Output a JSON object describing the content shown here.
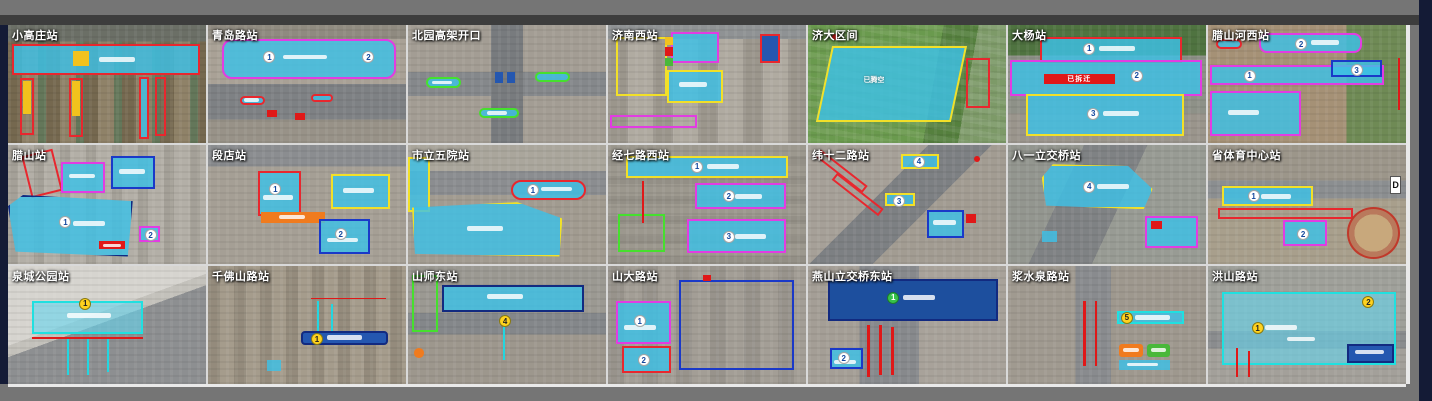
{
  "grid": {
    "columns": 7,
    "rows": 3
  },
  "tiles": [
    {
      "label": "小高庄站",
      "annotations": []
    },
    {
      "label": "青岛路站",
      "annotations": [
        "1",
        "2"
      ]
    },
    {
      "label": "北园高架开口",
      "annotations": []
    },
    {
      "label": "济南西站",
      "annotations": []
    },
    {
      "label": "济大区间",
      "annotations": [
        "已腾空"
      ]
    },
    {
      "label": "大杨站",
      "annotations": [
        "1",
        "2",
        "3",
        "已拆迁"
      ]
    },
    {
      "label": "腊山河西站",
      "annotations": [
        "2",
        "1",
        "3"
      ]
    },
    {
      "label": "腊山站",
      "annotations": [
        "1",
        "2"
      ]
    },
    {
      "label": "段店站",
      "annotations": [
        "1",
        "2"
      ]
    },
    {
      "label": "市立五院站",
      "annotations": [
        "1"
      ]
    },
    {
      "label": "经七路西站",
      "annotations": [
        "1",
        "2",
        "3"
      ]
    },
    {
      "label": "纬十二路站",
      "annotations": [
        "4",
        "3"
      ]
    },
    {
      "label": "八一立交桥站",
      "annotations": [
        "4"
      ]
    },
    {
      "label": "省体育中心站",
      "annotations": [
        "1",
        "2",
        "D"
      ]
    },
    {
      "label": "泉城公园站",
      "annotations": [
        "1"
      ]
    },
    {
      "label": "千佛山路站",
      "annotations": [
        "1"
      ]
    },
    {
      "label": "山师东站",
      "annotations": [
        "4"
      ]
    },
    {
      "label": "山大路站",
      "annotations": [
        "1",
        "2"
      ]
    },
    {
      "label": "燕山立交桥东站",
      "annotations": [
        "1",
        "2"
      ]
    },
    {
      "label": "浆水泉路站",
      "annotations": [
        "5"
      ]
    },
    {
      "label": "洪山路站",
      "annotations": [
        "1",
        "2"
      ]
    }
  ],
  "colors": {
    "zone_cyan_fill": "#3dc1e6",
    "outline_red": "#e8272e",
    "outline_yellow": "#f2e028",
    "outline_magenta": "#e23ce2",
    "outline_blue": "#1a39c8",
    "outline_green": "#46e02e",
    "dark_blue_fill": "#1d4f9e",
    "banner_red": "#e01818",
    "banner_orange": "#f07b1e",
    "marker_yellow": "#f2c21d",
    "frame_navy": "#141b36",
    "frame_gray": "#757575"
  }
}
